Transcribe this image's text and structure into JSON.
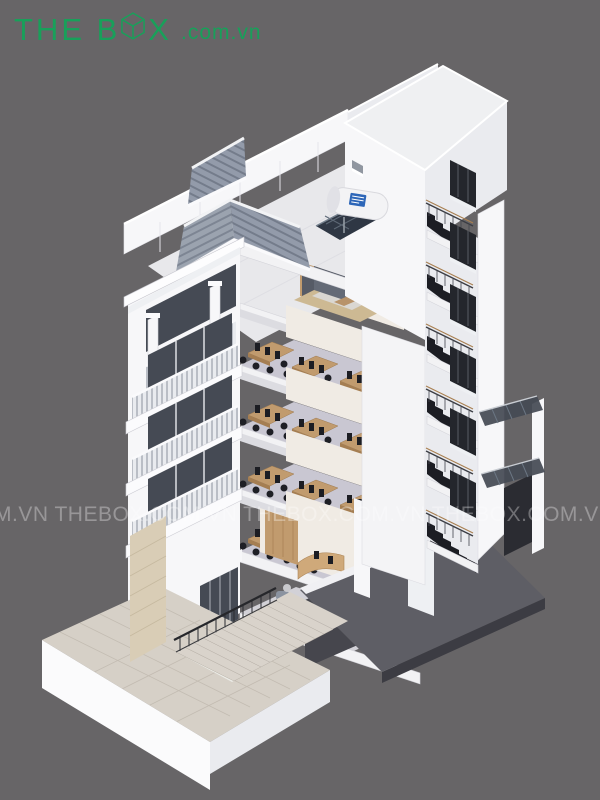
{
  "canvas": {
    "width": 600,
    "height": 800,
    "background": "#676567"
  },
  "logo": {
    "text_before_box": "THE B",
    "text_after_box": "X",
    "suffix": ".com.vn",
    "color": "#18a05a"
  },
  "watermark": {
    "text": "M.VN   THEBOX.COM.VN   THEBOX.COM.VN   THEBOX.COM.VN   THEBOX.COM",
    "color": "rgba(255,255,255,0.32)"
  },
  "scene": {
    "type": "isometric-architectural-section-render",
    "subject": "multi-storey building cutaway with office floors, stair shaft, rooftop terrace and entrance stairs",
    "palette": {
      "background": "#676567",
      "walls_light": "#f7f7f9",
      "walls_shaded": "#eaebef",
      "slate_roof": "#9aa2ae",
      "interior_floor": "#c9c7d2",
      "desk_wood": "#c19b6e",
      "stair_dark": "#1c1d23",
      "window_glass": "#454a54",
      "paving": "#d6d0c7",
      "basement_concrete": "#5e5e65",
      "handrail_wood": "#a87f50",
      "solar_tank_label_blue": "#2d66b8"
    }
  }
}
